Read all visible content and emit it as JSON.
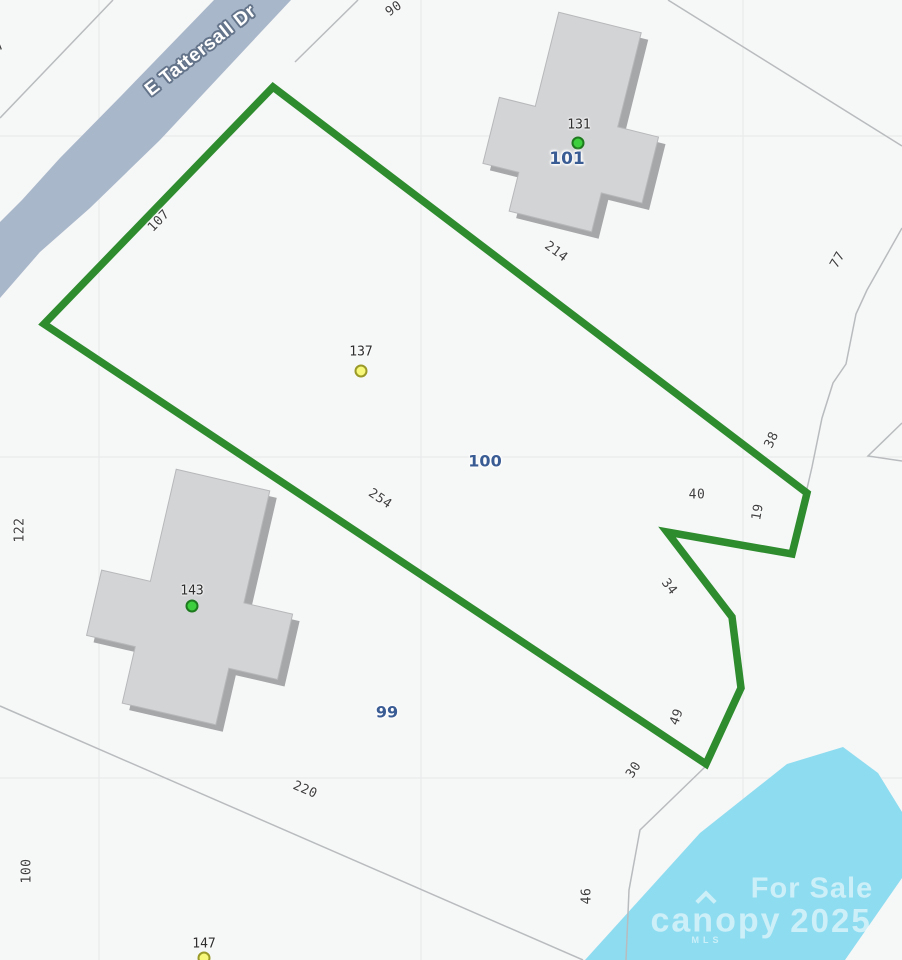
{
  "map": {
    "road_name": "E Tattersall Dr",
    "parcel_numbers": {
      "p101": "101",
      "p100": "100",
      "p99": "99"
    },
    "markers": {
      "m131": "131",
      "m137": "137",
      "m143": "143",
      "m147": "147"
    },
    "dimensions": {
      "d7": "7",
      "d90": "90",
      "d107": "107",
      "d214": "214",
      "d77": "77",
      "d38": "38",
      "d40": "40",
      "d19": "19",
      "d34": "34",
      "d254": "254",
      "d122": "122",
      "d49": "49",
      "d30": "30",
      "d220": "220",
      "d100_left": "100",
      "d46": "46"
    },
    "watermark": {
      "sale": "For Sale",
      "brand": "canopy",
      "brand_sub": "MLS",
      "year": "2025"
    },
    "colors": {
      "boundary_green": "#2e8c2e",
      "road_fill": "#a9b7ca",
      "water_fill": "#8edcf0",
      "building_fill": "#d3d4d6",
      "building_shadow": "#a6a7a9",
      "parcel_number_blue": "#3a5c94",
      "marker_green": "#3ecf3e",
      "marker_yellow": "#f7f77a"
    }
  }
}
